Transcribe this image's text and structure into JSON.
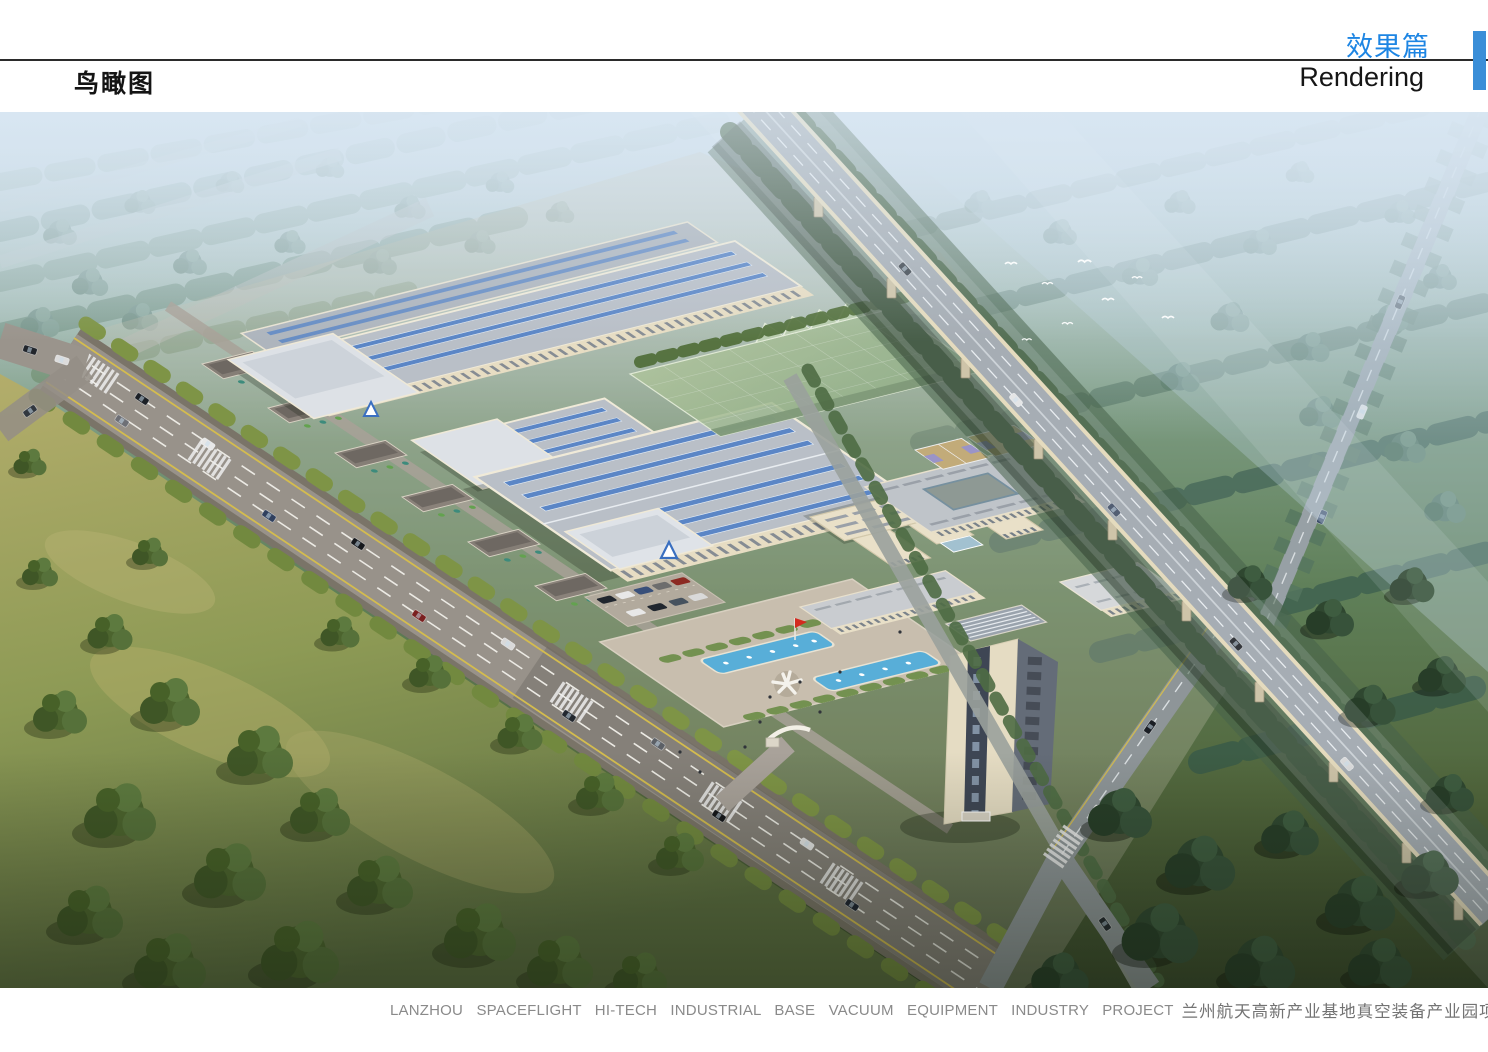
{
  "header": {
    "page_label_cn": "鸟瞰图",
    "section_title_cn": "效果篇",
    "section_title_en": "Rendering"
  },
  "footer": {
    "caption_en": "LANZHOU  SPACEFLIGHT  HI-TECH INDUSTRIAL BASE  VACUUM  EQUIPMENT  INDUSTRY  PROJECT",
    "caption_cn": "兰州航天高新产业基地真空装备产业园项目"
  },
  "colors": {
    "accent_blue": "#1d85e3",
    "corner_tab_blue": "#3a8ed8",
    "caption_square_blue": "#469ade",
    "caption_gray": "#8a8a8a",
    "roof_skylight_blue": "#5b86c6",
    "pool_blue": "#58aed8",
    "flag_red": "#d32b20"
  },
  "rendering": {
    "title": "Aerial bird's-eye view rendering of the industrial park",
    "features": [
      "elevated-highway-viaduct",
      "factory-halls-with-blue-skylights",
      "green-mesh-enclosure",
      "office-building",
      "courtyard-building",
      "tower-building",
      "basketball-courts",
      "fountain-pools",
      "sculpture",
      "red-flag",
      "main-street-with-cars",
      "street-shops",
      "tree-clusters",
      "flying-birds",
      "crosswalks",
      "parking-lot",
      "entrance-gate"
    ]
  }
}
